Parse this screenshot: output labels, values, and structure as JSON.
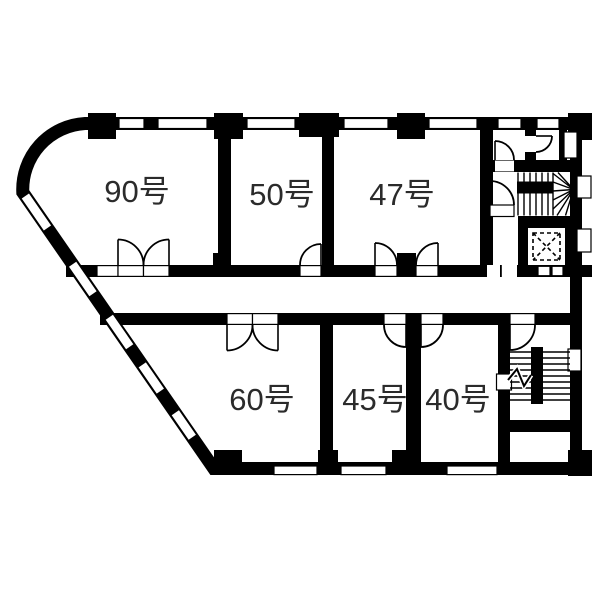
{
  "plan": {
    "background": "#ffffff",
    "wall_color": "#000000",
    "label_color": "#2b2b2b",
    "rooms": [
      {
        "id": "90",
        "label": "90号"
      },
      {
        "id": "50",
        "label": "50号"
      },
      {
        "id": "47",
        "label": "47号"
      },
      {
        "id": "60",
        "label": "60号"
      },
      {
        "id": "45",
        "label": "45号"
      },
      {
        "id": "40",
        "label": "40号"
      }
    ]
  }
}
